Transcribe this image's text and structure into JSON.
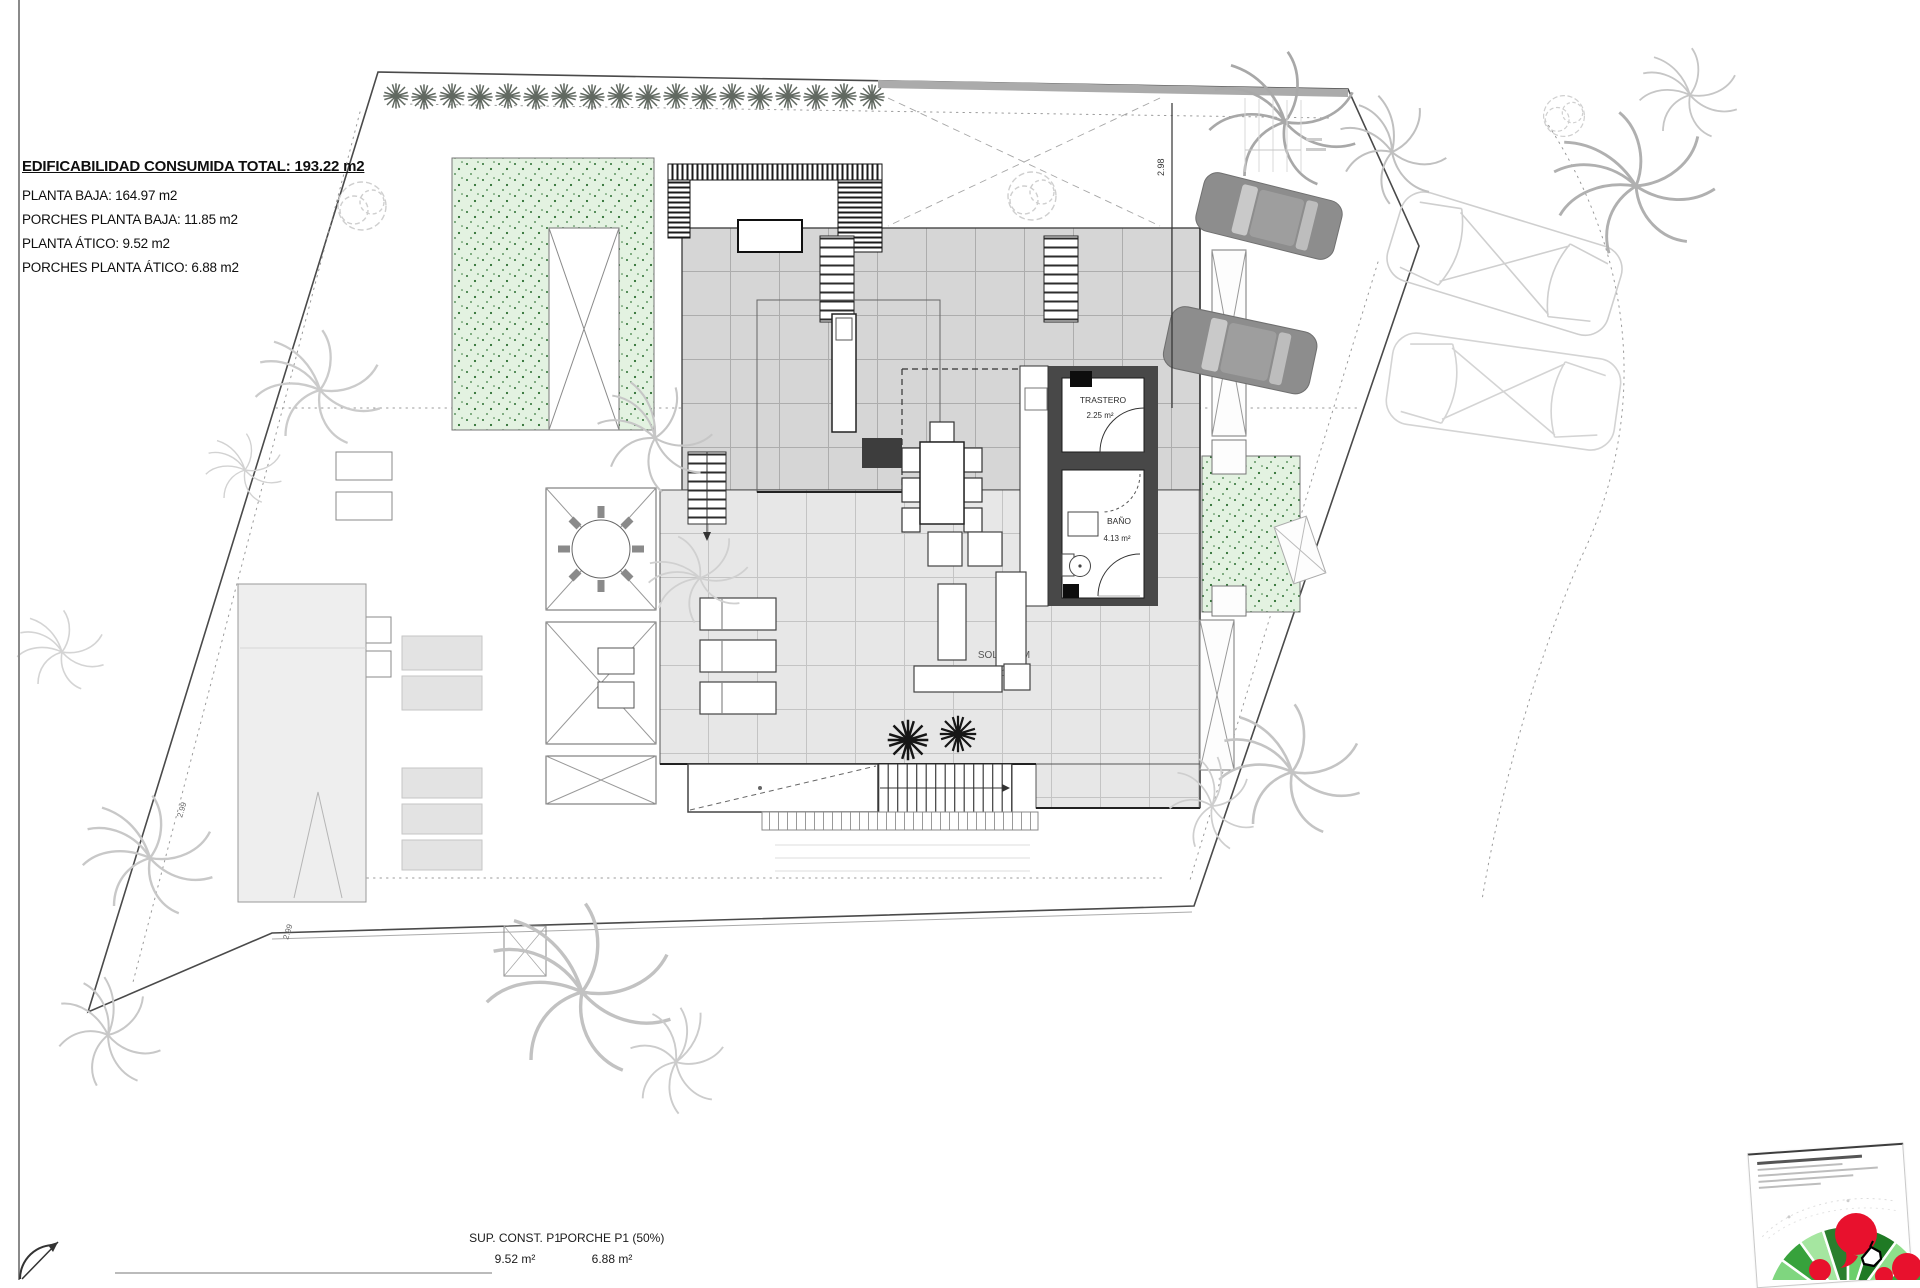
{
  "colors": {
    "bed_green": "#e3f2e1",
    "bed_dot": "#2c6e31",
    "tile_upper": "#d6d6d6",
    "tile_lower": "#e7e7e7",
    "wall_dark": "#484848",
    "logo_red": "#e8112d",
    "fan_green": "#2f9e3f"
  },
  "summary": {
    "title": "EDIFICABILIDAD CONSUMIDA TOTAL: 193.22 m2",
    "lines": [
      "PLANTA BAJA: 164.97 m2",
      "PORCHES PLANTA BAJA: 11.85 m2",
      "PLANTA ÁTICO: 9.52 m2",
      "PORCHES PLANTA ÁTICO: 6.88 m2"
    ]
  },
  "rooms": {
    "trastero": {
      "name": "TRASTERO",
      "area": "2.25 m²"
    },
    "bano": {
      "name": "BAÑO",
      "area": "4.13 m²"
    },
    "solarium": {
      "name": "SOLARIUM",
      "area": "123.19 m²"
    }
  },
  "footer": {
    "left": {
      "label": "SUP. CONST. P1",
      "value": "9.52 m²"
    },
    "right": {
      "label": "PORCHE P1 (50%)",
      "value": "6.88 m²"
    }
  },
  "dimensions": {
    "right_side": "2.98",
    "left_upper": "2.99",
    "left_lower": "2.99"
  }
}
